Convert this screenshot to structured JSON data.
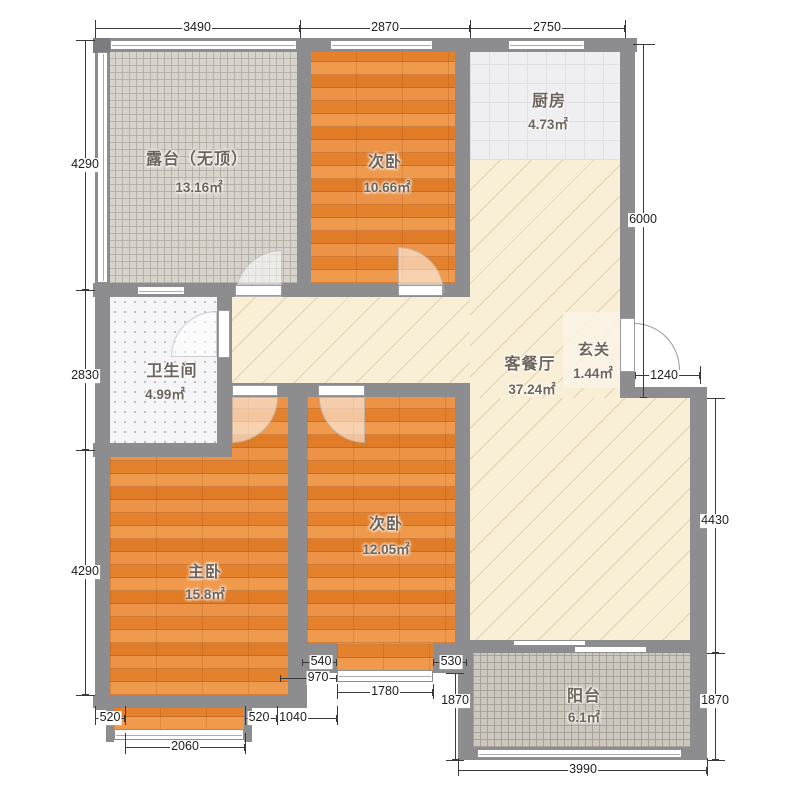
{
  "plan": {
    "rooms": {
      "terrace": {
        "name": "露台（无顶）",
        "area": "13.16㎡"
      },
      "bedroom_top": {
        "name": "次卧",
        "area": "10.66㎡"
      },
      "kitchen": {
        "name": "厨房",
        "area": "4.73㎡"
      },
      "bathroom": {
        "name": "卫生间",
        "area": "4.99㎡"
      },
      "living_dining": {
        "name": "客餐厅",
        "area": "37.24㎡"
      },
      "entry": {
        "name": "玄关",
        "area": "1.44㎡"
      },
      "master": {
        "name": "主卧",
        "area": "15.8㎡"
      },
      "bedroom_bottom": {
        "name": "次卧",
        "area": "12.05㎡"
      },
      "balcony": {
        "name": "阳台",
        "area": "6.1㎡"
      }
    },
    "dims": {
      "top_1": "3490",
      "top_2": "2870",
      "top_3": "2750",
      "left_1": "4290",
      "left_2": "2830",
      "left_3": "4290",
      "right_1": "6000",
      "right_2": "1240",
      "right_3": "4430",
      "right_4": "1870",
      "bot_520_left": "520",
      "bot_2060": "2060",
      "bot_520_mid": "520",
      "bot_1040": "1040",
      "bot_540": "540",
      "bot_970": "970",
      "bot_1780": "1780",
      "bot_530": "530",
      "bot_1870_left": "1870",
      "bot_3990": "3990"
    },
    "colors": {
      "wall": "#8d8d90",
      "wood_floor": "#e5873a",
      "living_floor": "#f8efd6",
      "terrace_tile": "#d8d4cd",
      "kitchen_tile": "#efeff2",
      "bath_tile": "#f5f5f8",
      "balcony_tile": "#cdc8bf"
    }
  }
}
